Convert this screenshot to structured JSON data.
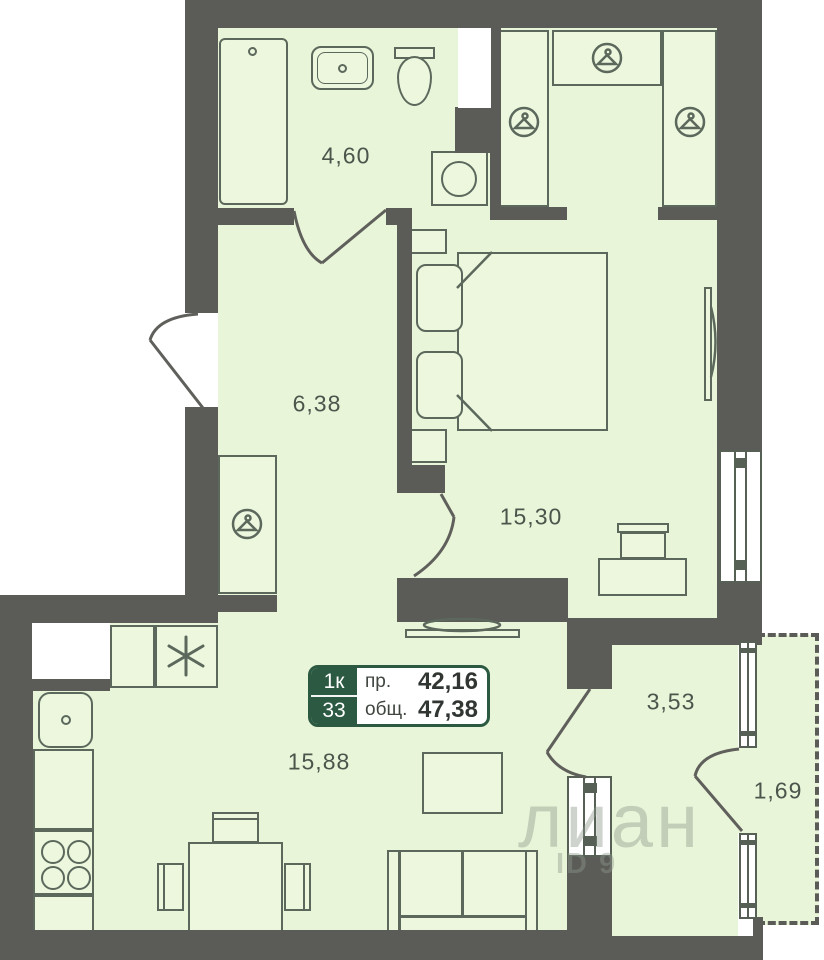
{
  "label_box": {
    "rooms_badge": "1к",
    "floor_badge": "33",
    "living_label": "пр.",
    "living_value": "42,16",
    "total_label": "общ.",
    "total_value": "47,38"
  },
  "areas": {
    "bathroom": "4,60",
    "hallway": "6,38",
    "bedroom": "15,30",
    "living_kitchen": "15,88",
    "loggia": "3,53",
    "balcony": "1,69"
  },
  "watermark": {
    "brand": "лиан",
    "listing_id": "ID 9"
  },
  "icons": [
    "hanger-icon",
    "fridge-asterisk-icon"
  ],
  "colors": {
    "wall": "#5b5b57",
    "floor": "#e9f5d9",
    "outline": "#5c685c",
    "accent_green": "#2b5941",
    "label_text": "#4b554c"
  }
}
